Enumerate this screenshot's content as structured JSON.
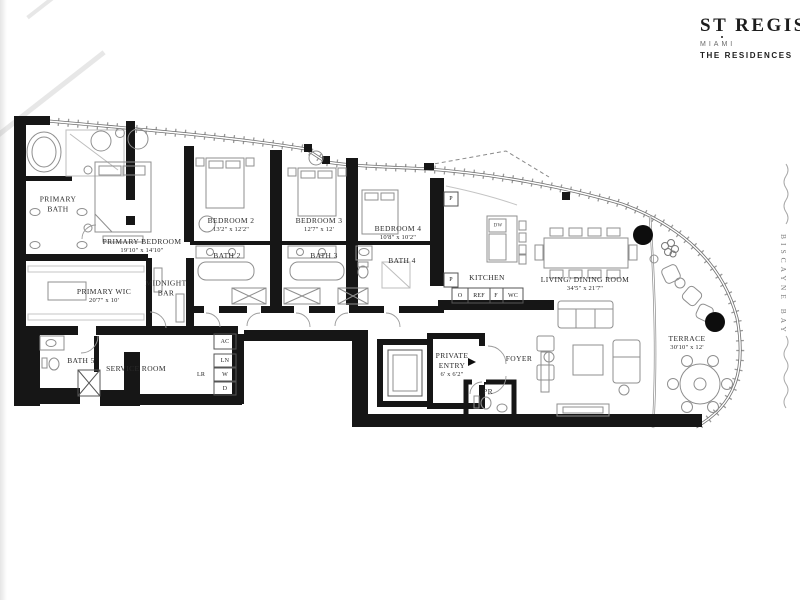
{
  "brand": {
    "name": "ST REGIS",
    "city": "MIAMI",
    "collection": "THE RESIDENCES"
  },
  "water_label": "BISCAYNE BAY",
  "rooms": [
    {
      "name": "PRIMARY BATH",
      "dims": ""
    },
    {
      "name": "PRIMARY BEDROOM",
      "dims": "19'10\" x 14'10\""
    },
    {
      "name": "PRIMARY WIC",
      "dims": "20'7\" x 10'"
    },
    {
      "name": "MIDNIGHT BAR",
      "dims": ""
    },
    {
      "name": "BEDROOM 2",
      "dims": "13'2\" x 12'2\""
    },
    {
      "name": "BATH 2",
      "dims": ""
    },
    {
      "name": "BEDROOM 3",
      "dims": "12'7\" x 12'"
    },
    {
      "name": "BATH 3",
      "dims": ""
    },
    {
      "name": "BEDROOM 4",
      "dims": "10'8\" x 10'2\""
    },
    {
      "name": "BATH 4",
      "dims": ""
    },
    {
      "name": "KITCHEN",
      "dims": ""
    },
    {
      "name": "LIVING/ DINING ROOM",
      "dims": "34'5\" x 21'7\""
    },
    {
      "name": "TERRACE",
      "dims": "30'10\" x 12'"
    },
    {
      "name": "PRIVATE ENTRY",
      "dims": "6' x 6'2\""
    },
    {
      "name": "FOYER",
      "dims": ""
    },
    {
      "name": "PR",
      "dims": ""
    },
    {
      "name": "BATH 5",
      "dims": ""
    },
    {
      "name": "SERVICE ROOM",
      "dims": ""
    }
  ],
  "fixtures": {
    "ac": "AC",
    "linen": "LN",
    "washer": "W",
    "dryer": "D",
    "lr": "LR",
    "dishwasher": "DW",
    "oven": "O",
    "refrigerator": "REF",
    "freezer": "F",
    "wine_cooler": "WC",
    "pantry": "P"
  },
  "colors": {
    "wall": "#161616",
    "furniture": "#8f8f8f",
    "glass": "#8f8f8f",
    "ink": "#2b2b2b"
  }
}
